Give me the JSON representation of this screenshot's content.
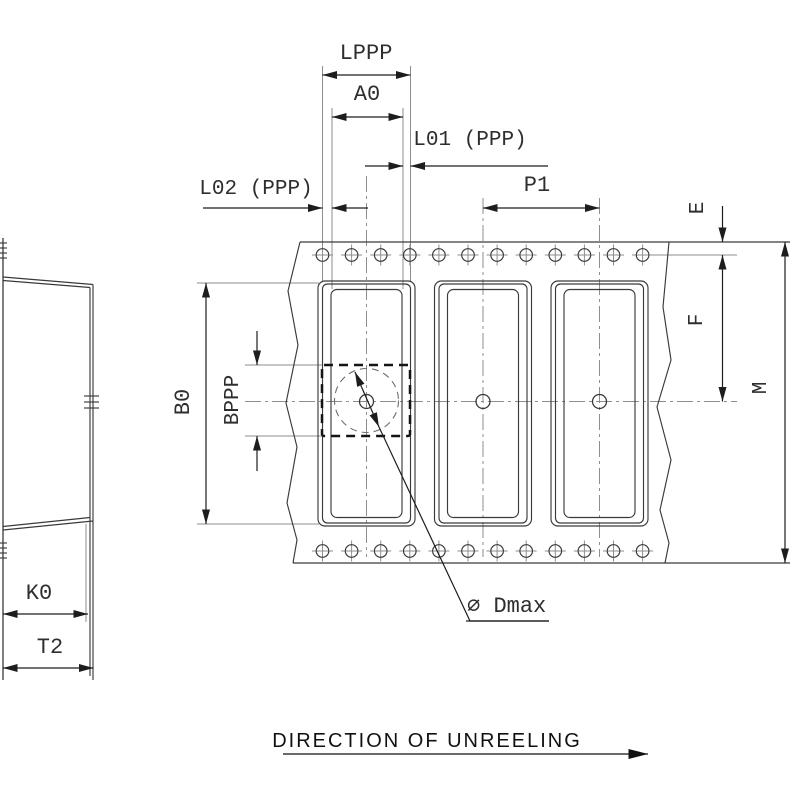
{
  "labels": {
    "lppp": "LPPP",
    "a0": "A0",
    "l01": "L01 (PPP)",
    "l02": "L02 (PPP)",
    "p1": "P1",
    "e": "E",
    "f": "F",
    "m": "M",
    "b0": "B0",
    "bppp": "BPPP",
    "k0": "K0",
    "t2": "T2",
    "dmax": "∅ Dmax",
    "direction": "DIRECTION OF UNREELING"
  },
  "counts": {
    "pockets_visible": 3,
    "sprocket_holes_top_row": 12,
    "sprocket_holes_bottom_row": 12
  },
  "colors": {
    "background": "#ffffff",
    "drawing_lines": "#3a3a3a",
    "dimension_lines": "#1d1d1d",
    "extension_lines": "#8e8e8e",
    "label_text": "#2e2e2e",
    "direction_text": "#111111"
  }
}
